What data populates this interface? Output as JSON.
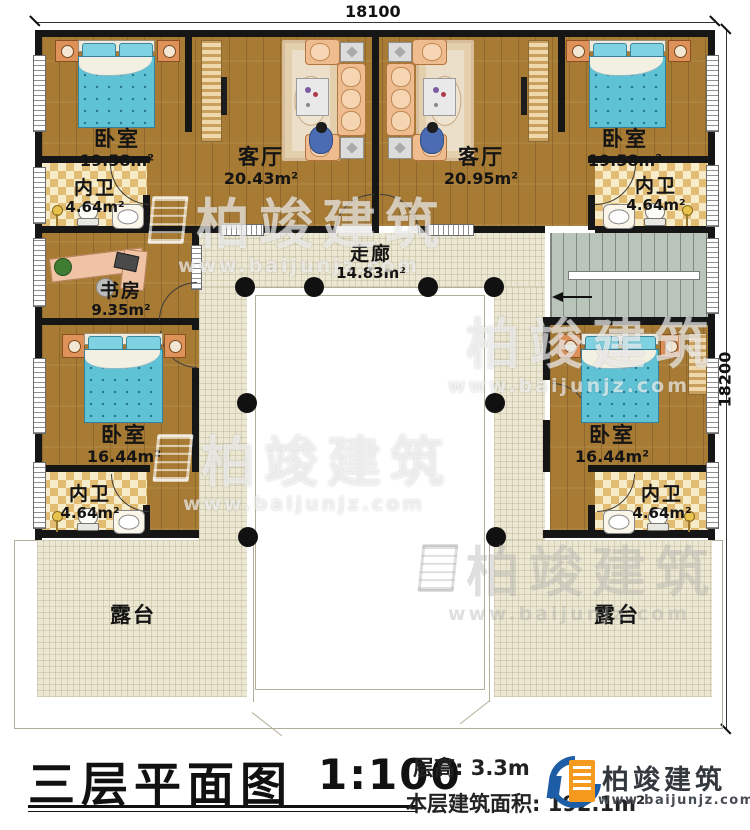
{
  "dimensions": {
    "top": "18100",
    "right": "18200"
  },
  "rooms": [
    {
      "id": "bedroom-top-left",
      "name": "卧室",
      "area": "19.58m²"
    },
    {
      "id": "bath-top-left",
      "name": "内卫",
      "area": "4.64m²"
    },
    {
      "id": "living-top-left",
      "name": "客厅",
      "area": "20.43m²"
    },
    {
      "id": "living-top-right",
      "name": "客厅",
      "area": "20.95m²"
    },
    {
      "id": "bedroom-top-right",
      "name": "卧室",
      "area": "19.58m²"
    },
    {
      "id": "bath-top-right",
      "name": "内卫",
      "area": "4.64m²"
    },
    {
      "id": "study",
      "name": "书房",
      "area": "9.35m²"
    },
    {
      "id": "corridor",
      "name": "走廊",
      "area": "14.83m²"
    },
    {
      "id": "bedroom-mid-left",
      "name": "卧室",
      "area": "16.44m²"
    },
    {
      "id": "bath-bottom-left",
      "name": "内卫",
      "area": "4.64m²"
    },
    {
      "id": "bedroom-mid-right",
      "name": "卧室",
      "area": "16.44m²"
    },
    {
      "id": "bath-bottom-right",
      "name": "内卫",
      "area": "4.64m²"
    },
    {
      "id": "terrace-left",
      "name": "露台"
    },
    {
      "id": "terrace-right",
      "name": "露台"
    }
  ],
  "title": {
    "text": "三层平面图",
    "scale": "1:100"
  },
  "info": {
    "floor_height": "层高: 3.3m",
    "floor_area": "本层建筑面积: 192.1m²"
  },
  "brand": {
    "name": "柏竣建筑",
    "url": "www.baijunjz.com"
  },
  "watermark": {
    "text": "柏竣建筑",
    "url": "www.baijunjz.com"
  },
  "colors": {
    "wall": "#161616",
    "wood_floor": "#a87b34",
    "tile": "#ebe7d2",
    "bath_tile": "#e3bc74",
    "stairs": "#b9c4bb",
    "bed_blanket": "#5fc2d5",
    "logo_blue": "#1d5da6",
    "logo_orange": "#f59a1d"
  }
}
